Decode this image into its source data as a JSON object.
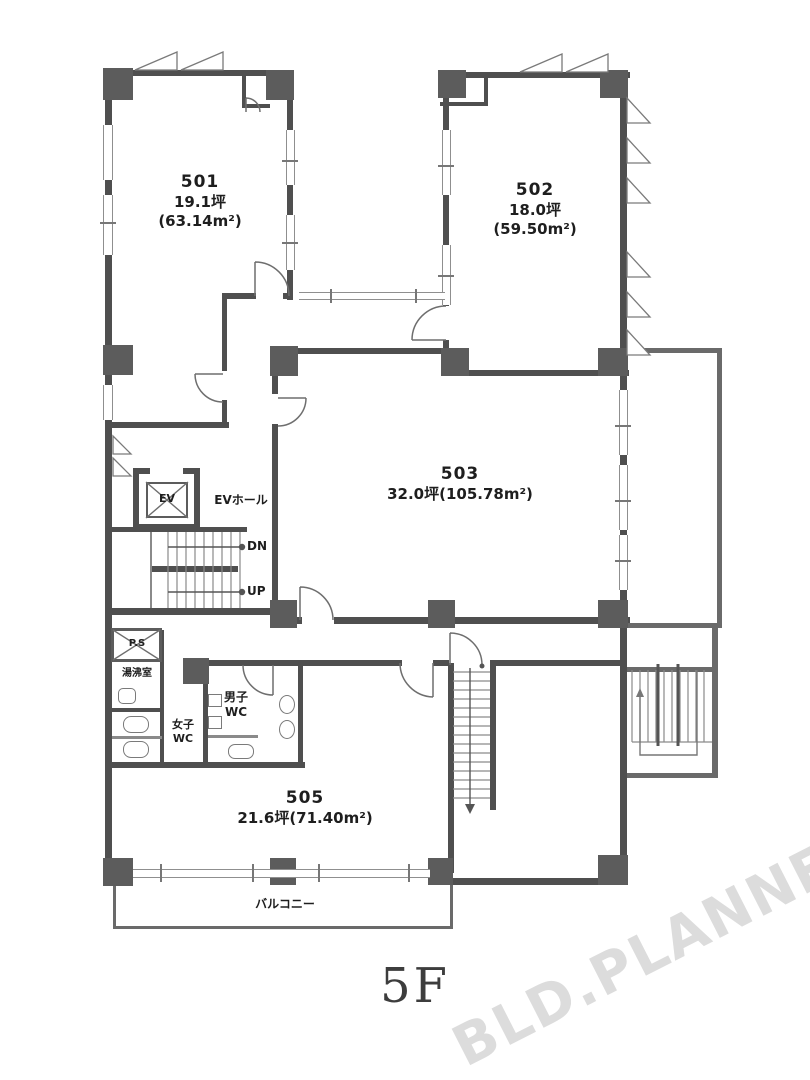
{
  "floor_label": "5F",
  "watermark": "BLD.PLANNER",
  "rooms": {
    "r501": {
      "num": "501",
      "line1": "19.1坪",
      "line2": "(63.14m²)"
    },
    "r502": {
      "num": "502",
      "line1": "18.0坪",
      "line2": "(59.50m²)"
    },
    "r503": {
      "num": "503",
      "line1": "32.0坪(105.78m²)"
    },
    "r505": {
      "num": "505",
      "line1": "21.6坪(71.40m²)"
    }
  },
  "labels": {
    "ev": "EV",
    "ev_hall": "EVホール",
    "dn": "DN",
    "up": "UP",
    "ps": "P.S",
    "kitchenette": "湯沸室",
    "mens": "男子",
    "mens_wc": "WC",
    "womens": "女子",
    "womens_wc": "WC",
    "balcony": "バルコニー"
  },
  "colors": {
    "wall": "#4f4f4f",
    "thin_line": "#8a8a8a",
    "text": "#1e1e1e",
    "watermark": "#dcdcdc"
  }
}
